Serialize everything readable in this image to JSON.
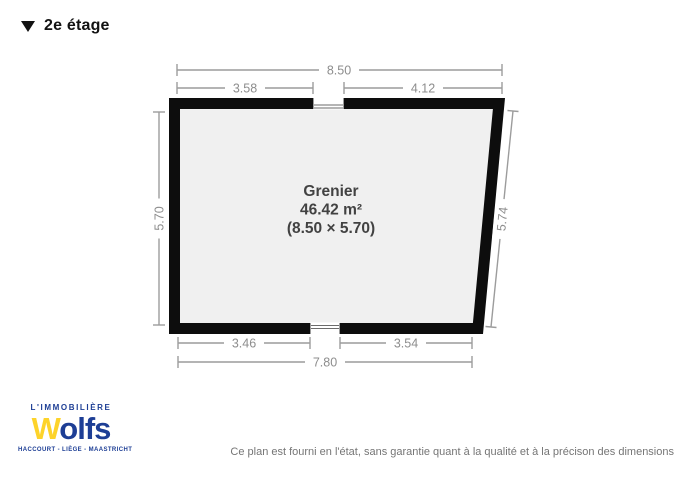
{
  "colors": {
    "wall": "#0d0d0d",
    "floor": "#f0f0f0",
    "dimension_lines": "#9c9c9c",
    "room_text": "#424242",
    "brand_blue": "#1d3e95",
    "brand_yellow": "#fdd32a",
    "disclaimer_text": "#757575"
  },
  "header": {
    "floor_label": "2e étage"
  },
  "plan": {
    "room": {
      "name": "Grenier",
      "area": "46.42 m²",
      "dimensions_label": "(8.50 × 5.70)"
    },
    "measurements": {
      "width_total": "8.50",
      "width_left": "3.58",
      "width_right": "4.12",
      "height_left": "5.70",
      "height_right": "5.74",
      "bottom_left": "3.46",
      "bottom_right": "3.54",
      "bottom_total": "7.80"
    }
  },
  "footer": {
    "logo": {
      "top_line": "L'IMMOBILIÈRE",
      "brand_initial": "W",
      "brand_rest": "olfs",
      "cities": "HACCOURT - LIÈGE - MAASTRICHT"
    },
    "disclaimer": "Ce plan est fourni en l'état, sans garantie quant à la qualité et à la précison des dimensions"
  }
}
